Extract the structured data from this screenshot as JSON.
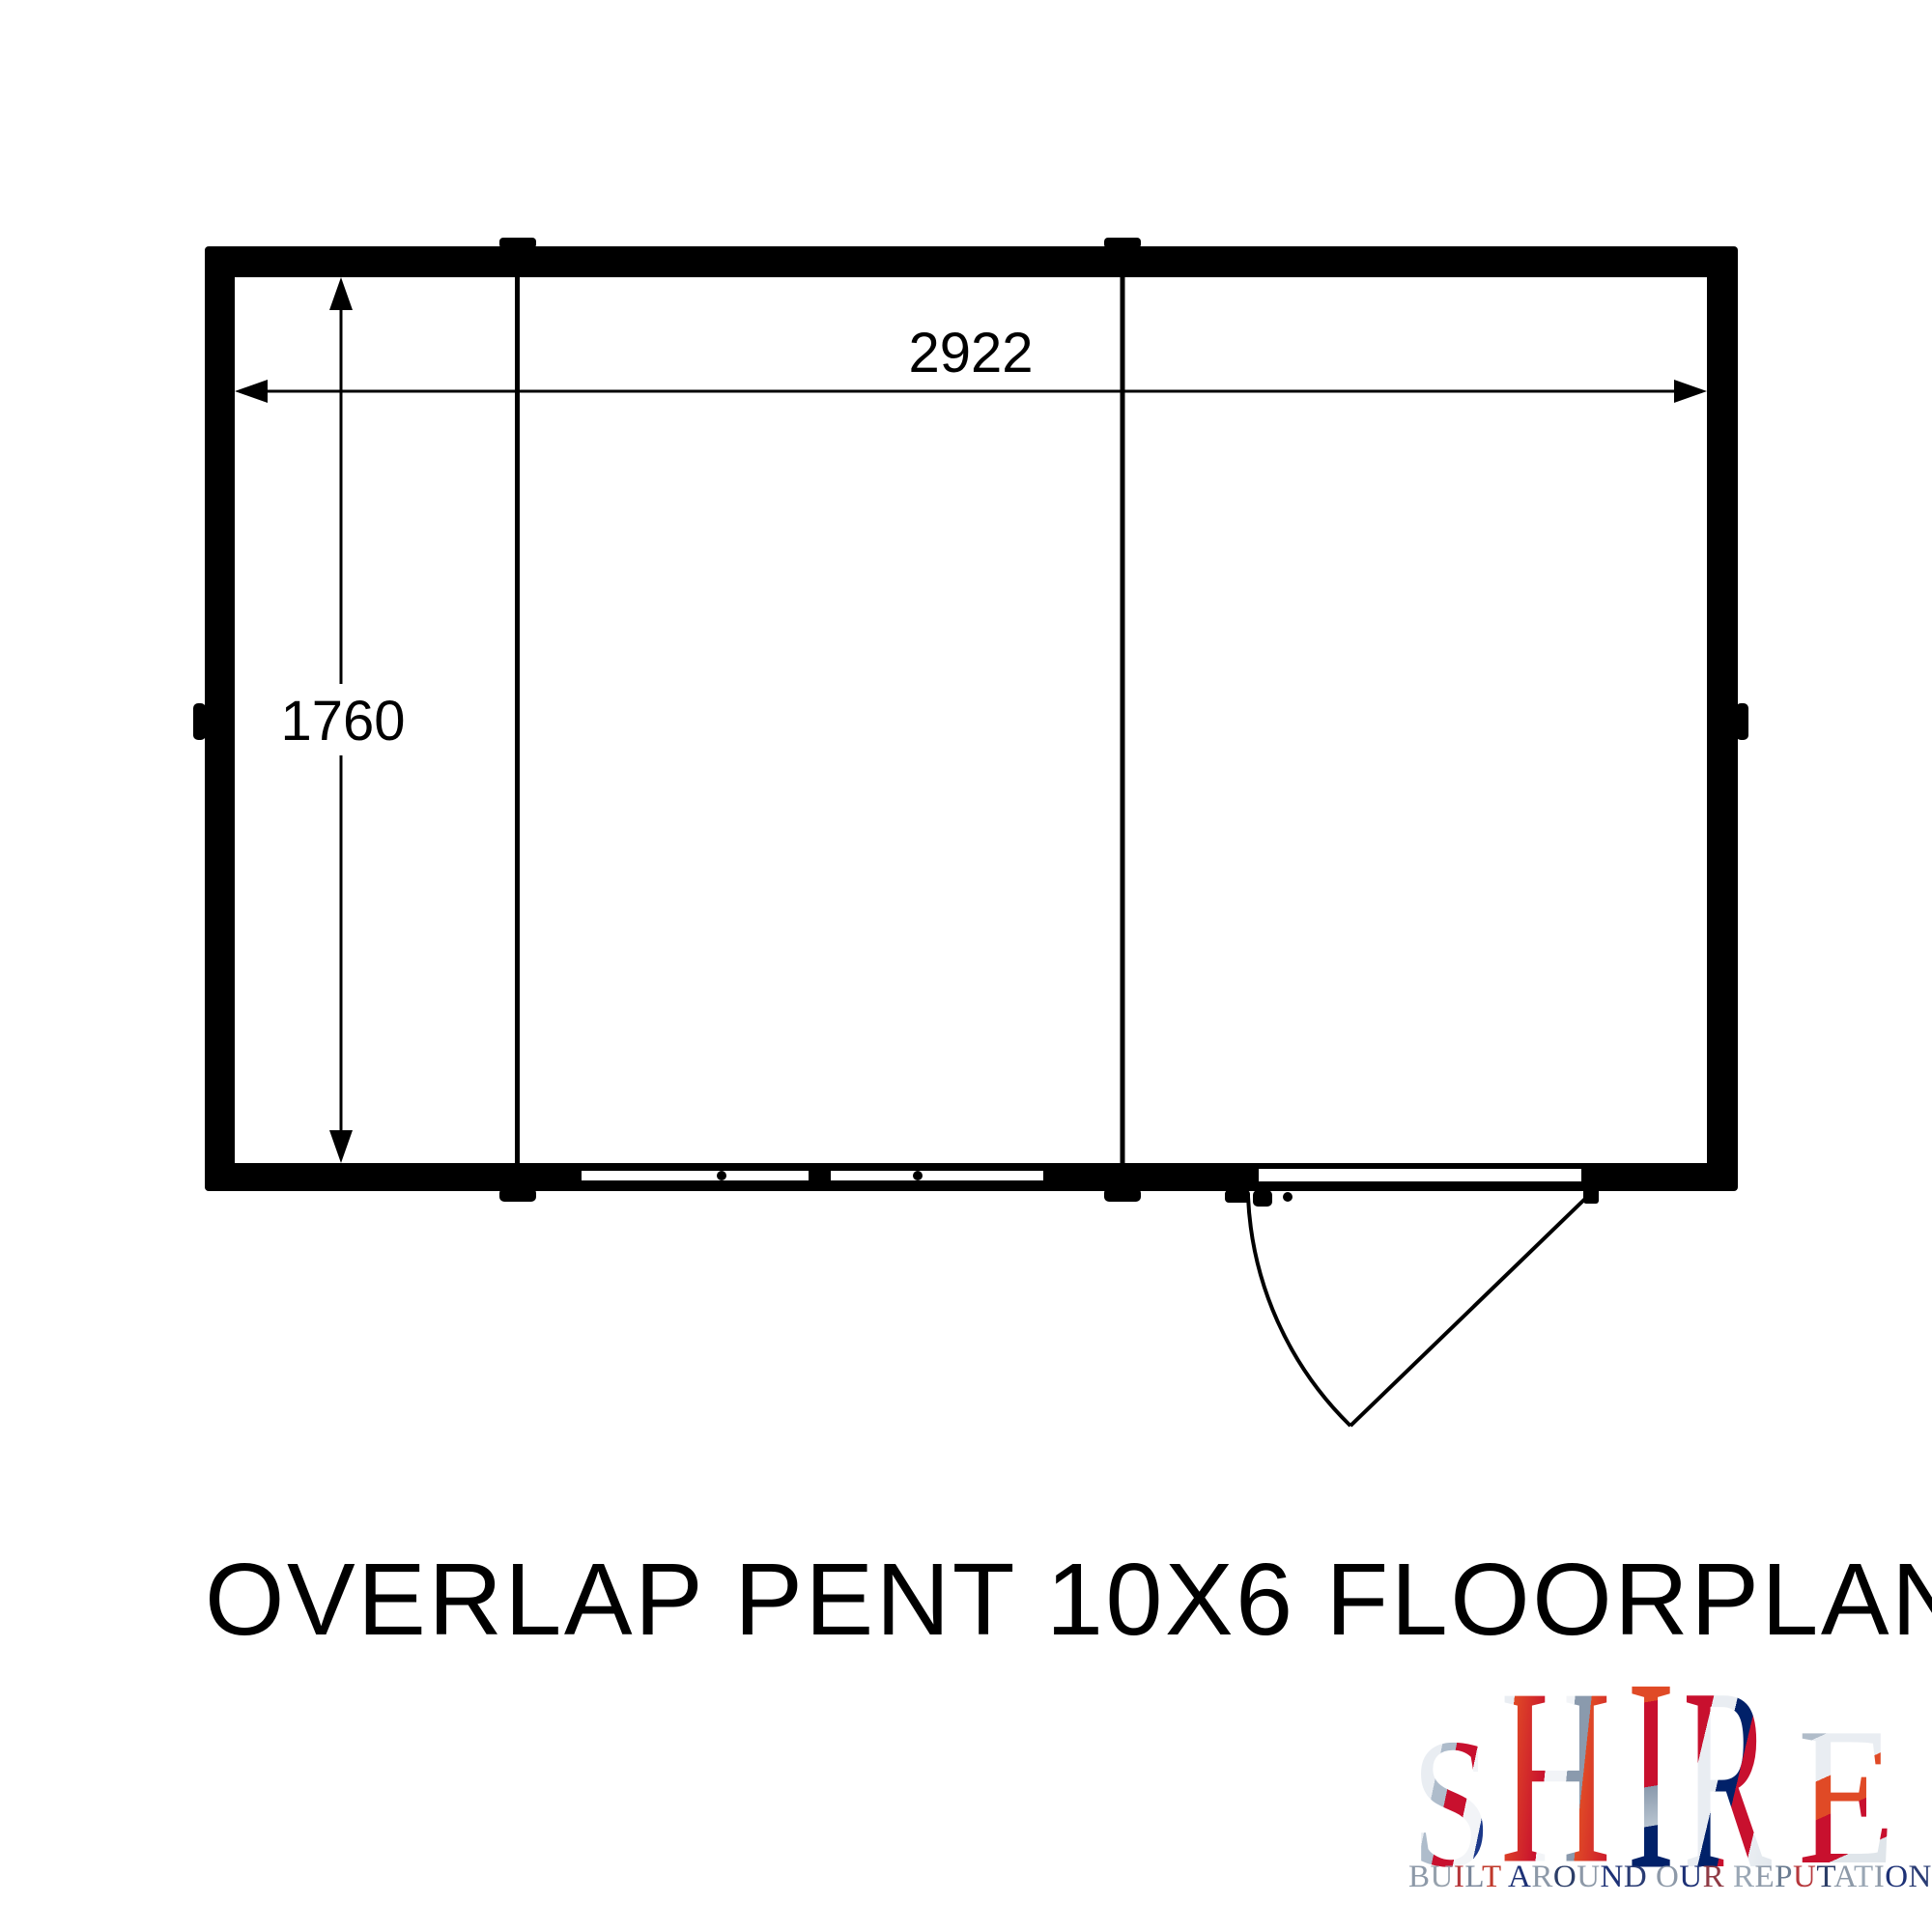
{
  "title": "OVERLAP PENT 10X6 FLOORPLAN",
  "floorplan": {
    "width_dim": "2922",
    "height_dim": "1760",
    "line_color": "#000000",
    "wall_color": "#000000",
    "floor_color": "#ffffff"
  },
  "logo": {
    "word": "SHIRE",
    "tagline": "BUILT AROUND OUR REPUTATION",
    "brand_colors": {
      "flag_red": "#c8102e",
      "flag_orange_red": "#e04a26",
      "flag_blue": "#012169",
      "flag_silver": "#e9edf2",
      "flag_steel": "#8a9aad"
    },
    "letter_gradients": [
      "linear-gradient(105deg, #c8102e 0%, #c8102e 18%, #e9edf2 18%, #e9edf2 32%, #aebccb 32%, #aebccb 44%, #c8102e 44%, #c8102e 62%, #f2f4f7 62%, #f2f4f7 78%, #1d3a8c 78%, #012169 100%)",
      "linear-gradient(100deg, #e9edf2 0%, #e9edf2 14%, #e04a26 14%, #c8102e 42%, #f2f4f7 42%, #f2f4f7 58%, #8a9aad 58%, #8a9aad 70%, #e04a26 70%, #c8102e 100%)",
      "linear-gradient(175deg, #e04a26 0%, #e04a26 24%, #c8102e 24%, #c8102e 54%, #8a9aad 54%, #b8c4d0 68%, #012169 68%, #012169 100%)",
      "linear-gradient(115deg, #c8102e 0%, #c8102e 28%, #e9edf2 28%, #e9edf2 44%, #012169 44%, #012169 57%, #c8102e 57%, #c8102e 76%, #e9edf2 76%, #dfe5ea 100%)",
      "linear-gradient(160deg, #b0bcc9 0%, #b0bcc9 20%, #e9edf2 20%, #e9edf2 38%, #e04a26 38%, #e04a26 54%, #c8102e 54%, #c8102e 74%, #dfe5ea 74%, #dfe5ea 100%)"
    ],
    "tagline_palette": [
      "#8d99a8",
      "#97a2ad",
      "#b5373b",
      "#7a879b",
      "#c0392b",
      "#1d3176",
      "#8d99a8",
      "#2c3e68",
      "#8d99a8",
      "#1d3176",
      "#2a3c74",
      "#8d99a8",
      "#1d3176",
      "#8f3a44",
      "#9aa7b5",
      "#8d99a8",
      "#6b7c91",
      "#b5373b",
      "#2c3e68",
      "#8d99a8",
      "#9aa7b5",
      "#8d99a8",
      "#1d3176",
      "#2a3c74",
      "#c0392b"
    ]
  }
}
